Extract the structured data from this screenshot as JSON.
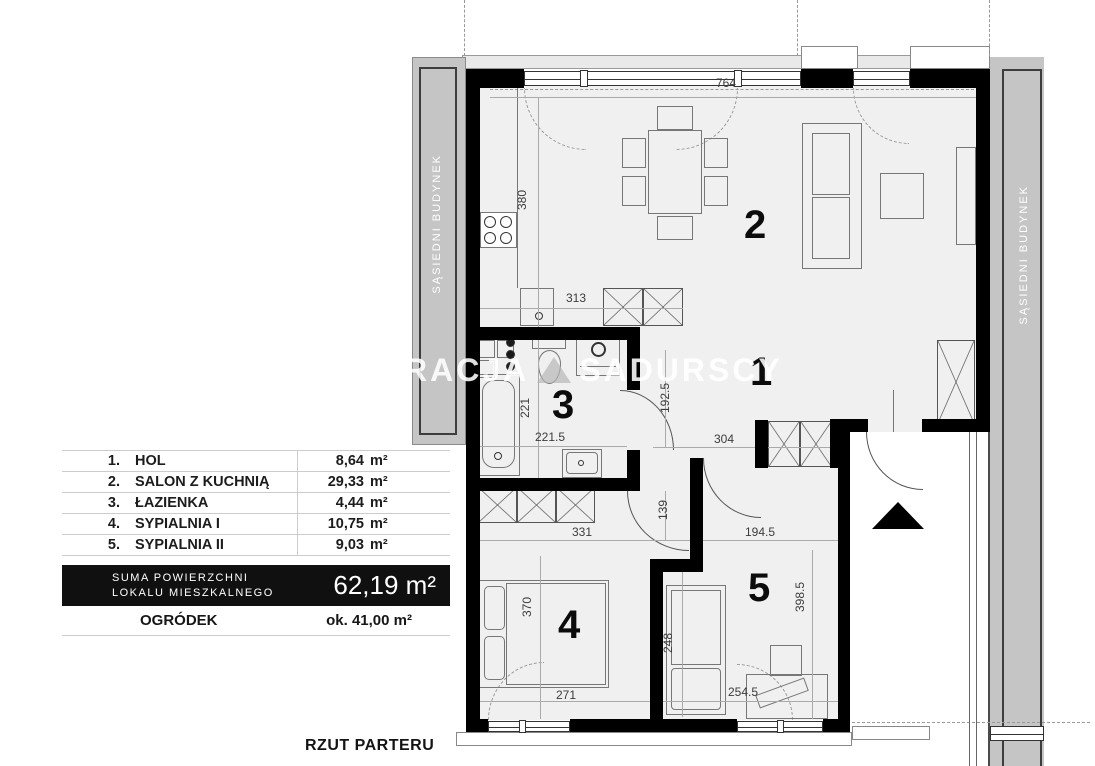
{
  "header": {
    "drawing_title": "RZUT PARTERU"
  },
  "watermark": {
    "part1": "RACJA",
    "part2": "SADURSCY"
  },
  "neighbors": {
    "left": "SĄSIEDNI BUDYNEK",
    "right": "SĄSIEDNI BUDYNEK"
  },
  "legend": {
    "rows": [
      {
        "no": "1.",
        "name": "HOL",
        "value": "8,64",
        "unit": "m²"
      },
      {
        "no": "2.",
        "name": "SALON Z KUCHNIĄ",
        "value": "29,33",
        "unit": "m²"
      },
      {
        "no": "3.",
        "name": "ŁAZIENKA",
        "value": "4,44",
        "unit": "m²"
      },
      {
        "no": "4.",
        "name": "SYPIALNIA I",
        "value": "10,75",
        "unit": "m²"
      },
      {
        "no": "5.",
        "name": "SYPIALNIA II",
        "value": "9,03",
        "unit": "m²"
      }
    ],
    "total": {
      "label_line1": "SUMA POWIERZCHNI",
      "label_line2": "LOKALU MIESZKALNEGO",
      "value": "62,19 m²"
    },
    "garden": {
      "label": "OGRÓDEK",
      "value": "ok. 41,00 m²"
    }
  },
  "room_numbers": {
    "hol": "1",
    "salon": "2",
    "lazienka": "3",
    "sypialnia1": "4",
    "sypialnia2": "5"
  },
  "dimensions": {
    "d764": "764",
    "d380": "380",
    "d313": "313",
    "d221": "221",
    "d221_5": "221.5",
    "d192_5": "192.5",
    "d304": "304",
    "d139": "139",
    "d194_5": "194.5",
    "d331": "331",
    "d370": "370",
    "d271": "271",
    "d248": "248",
    "d254_5": "254.5",
    "d398_5": "398.5"
  },
  "colors": {
    "wall": "#000000",
    "floor": "#f0f0f0",
    "neighbor_strip": "#c5c5c5",
    "legend_band": "#101010"
  }
}
